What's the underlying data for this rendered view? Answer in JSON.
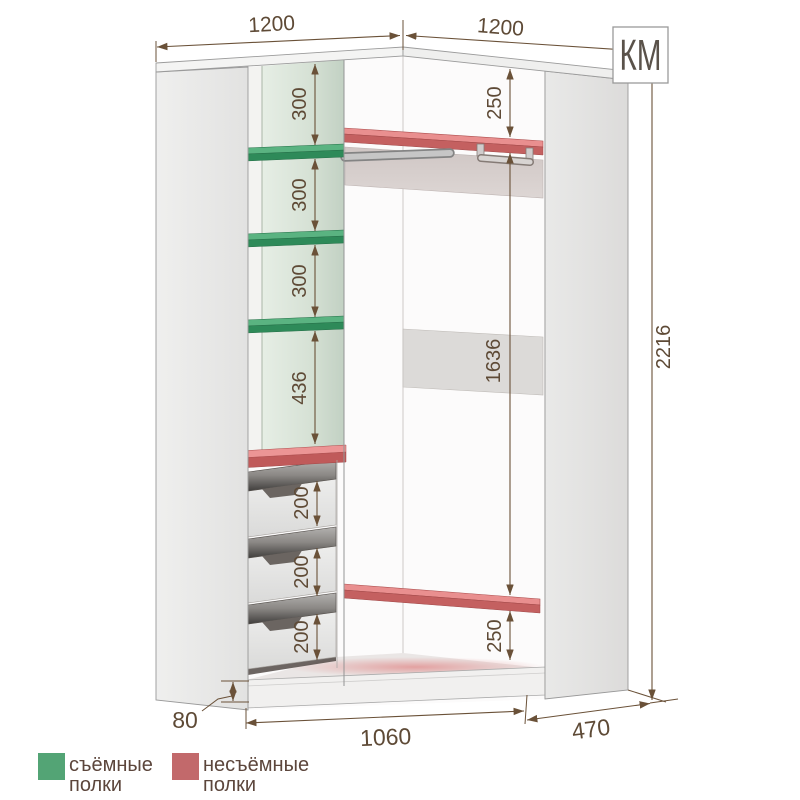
{
  "logo": {
    "text": "КМ"
  },
  "dims": {
    "top_left": "1200",
    "top_right": "1200",
    "gap1": "300",
    "gap2": "300",
    "gap3": "300",
    "gap4": "436",
    "right_top": "250",
    "hang": "1636",
    "right_bottom": "250",
    "height": "2216",
    "drawer1": "200",
    "drawer2": "200",
    "drawer3": "200",
    "plinth": "80",
    "front": "1060",
    "depth": "470"
  },
  "legend": {
    "removable": {
      "swatch": "#53a475",
      "line1": "съёмные",
      "line2": "полки"
    },
    "fixed": {
      "swatch": "#c2696b",
      "line1": "несъёмные",
      "line2": "полки"
    }
  },
  "colors": {
    "dimension": "#5e4a36",
    "shelf_green": "#58b07e",
    "shelf_red": "#e98f8f"
  }
}
